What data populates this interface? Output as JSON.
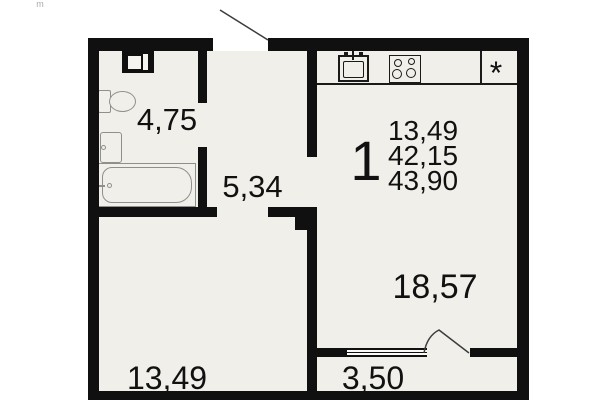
{
  "watermark": "m",
  "plan": {
    "summary": {
      "room_count": "1",
      "living_area": "13,49",
      "apartment_area": "42,15",
      "total_area": "43,90"
    },
    "rooms": {
      "bathroom": {
        "area": "4,75"
      },
      "hallway": {
        "area": "5,34"
      },
      "kitchen_living": {
        "area": "18,57"
      },
      "living_room": {
        "area": "13,49"
      },
      "balcony": {
        "area": "3,50"
      }
    },
    "symbols": {
      "fridge": "*"
    },
    "colors": {
      "wall": "#101010",
      "floor": "#f0efe9",
      "fixture": "#8f8f8c"
    }
  }
}
